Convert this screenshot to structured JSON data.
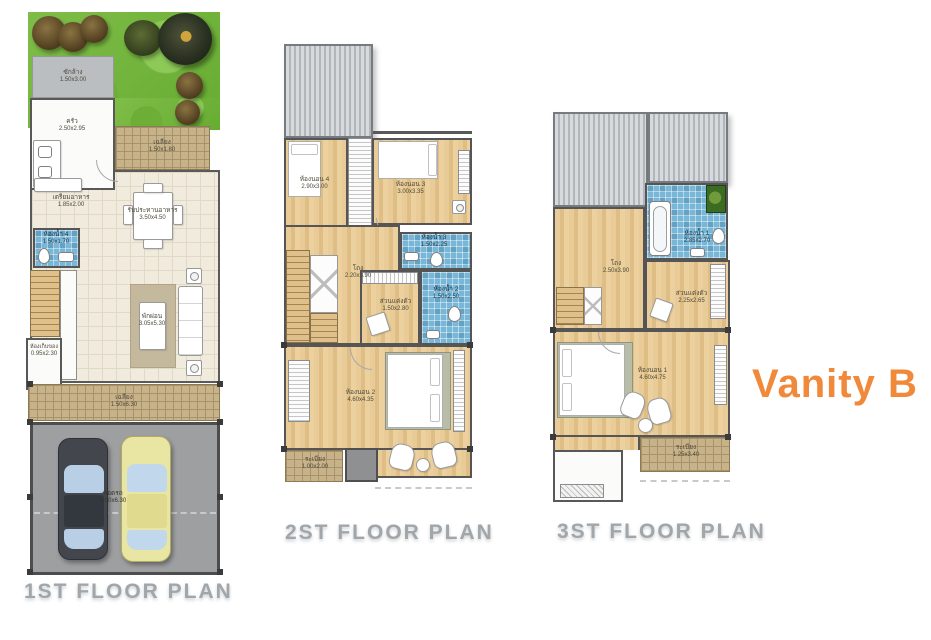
{
  "title": "Vanity B",
  "accent_color": "#F1893A",
  "plans": {
    "first": {
      "label": "1ST FLOOR PLAN",
      "rooms": {
        "laundry": {
          "name": "ซักล้าง",
          "dims": "1.50x3.00"
        },
        "kitchen": {
          "name": "ครัว",
          "dims": "2.50x2.95"
        },
        "porch": {
          "name": "เฉลียง",
          "dims": "1.50x1.80"
        },
        "pantry": {
          "name": "เตรียมอาหาร",
          "dims": "1.85x2.00"
        },
        "dining": {
          "name": "รับประทานอาหาร",
          "dims": "3.50x4.50"
        },
        "bath4": {
          "name": "ห้องน้ำ 4",
          "dims": "1.50x1.70"
        },
        "living": {
          "name": "พักผ่อน",
          "dims": "3.05x5.30"
        },
        "storage": {
          "name": "ห้องเก็บของ",
          "dims": "0.95x2.30"
        },
        "terrace": {
          "name": "เฉลียง",
          "dims": "1.50x6.30"
        },
        "parking": {
          "name": "จอดรถ",
          "dims": "5.00x6.30"
        }
      }
    },
    "second": {
      "label": "2ST FLOOR PLAN",
      "rooms": {
        "bedroom4": {
          "name": "ห้องนอน 4",
          "dims": "2.90x3.00"
        },
        "bedroom3": {
          "name": "ห้องนอน 3",
          "dims": "3.00x3.35"
        },
        "hall": {
          "name": "โถง",
          "dims": "2.20x3.90"
        },
        "bath3": {
          "name": "ห้องน้ำ 3",
          "dims": "1.50x2.25"
        },
        "bath2": {
          "name": "ห้องน้ำ 2",
          "dims": "1.50x2.50"
        },
        "dressing": {
          "name": "ส่วนแต่งตัว",
          "dims": "1.50x2.80"
        },
        "bedroom2": {
          "name": "ห้องนอน 2",
          "dims": "4.60x4.35"
        },
        "balcony": {
          "name": "ระเบียง",
          "dims": "1.00x2.00"
        }
      }
    },
    "third": {
      "label": "3ST FLOOR PLAN",
      "rooms": {
        "bath1": {
          "name": "ห้องน้ำ 1",
          "dims": "2.85x2.70"
        },
        "hall": {
          "name": "โถง",
          "dims": "2.50x3.90"
        },
        "dressing": {
          "name": "ส่วนแต่งตัว",
          "dims": "2.25x2.65"
        },
        "bedroom1": {
          "name": "ห้องนอน 1",
          "dims": "4.60x4.75"
        },
        "balcony": {
          "name": "ระเบียง",
          "dims": "1.25x3.40"
        }
      }
    }
  }
}
